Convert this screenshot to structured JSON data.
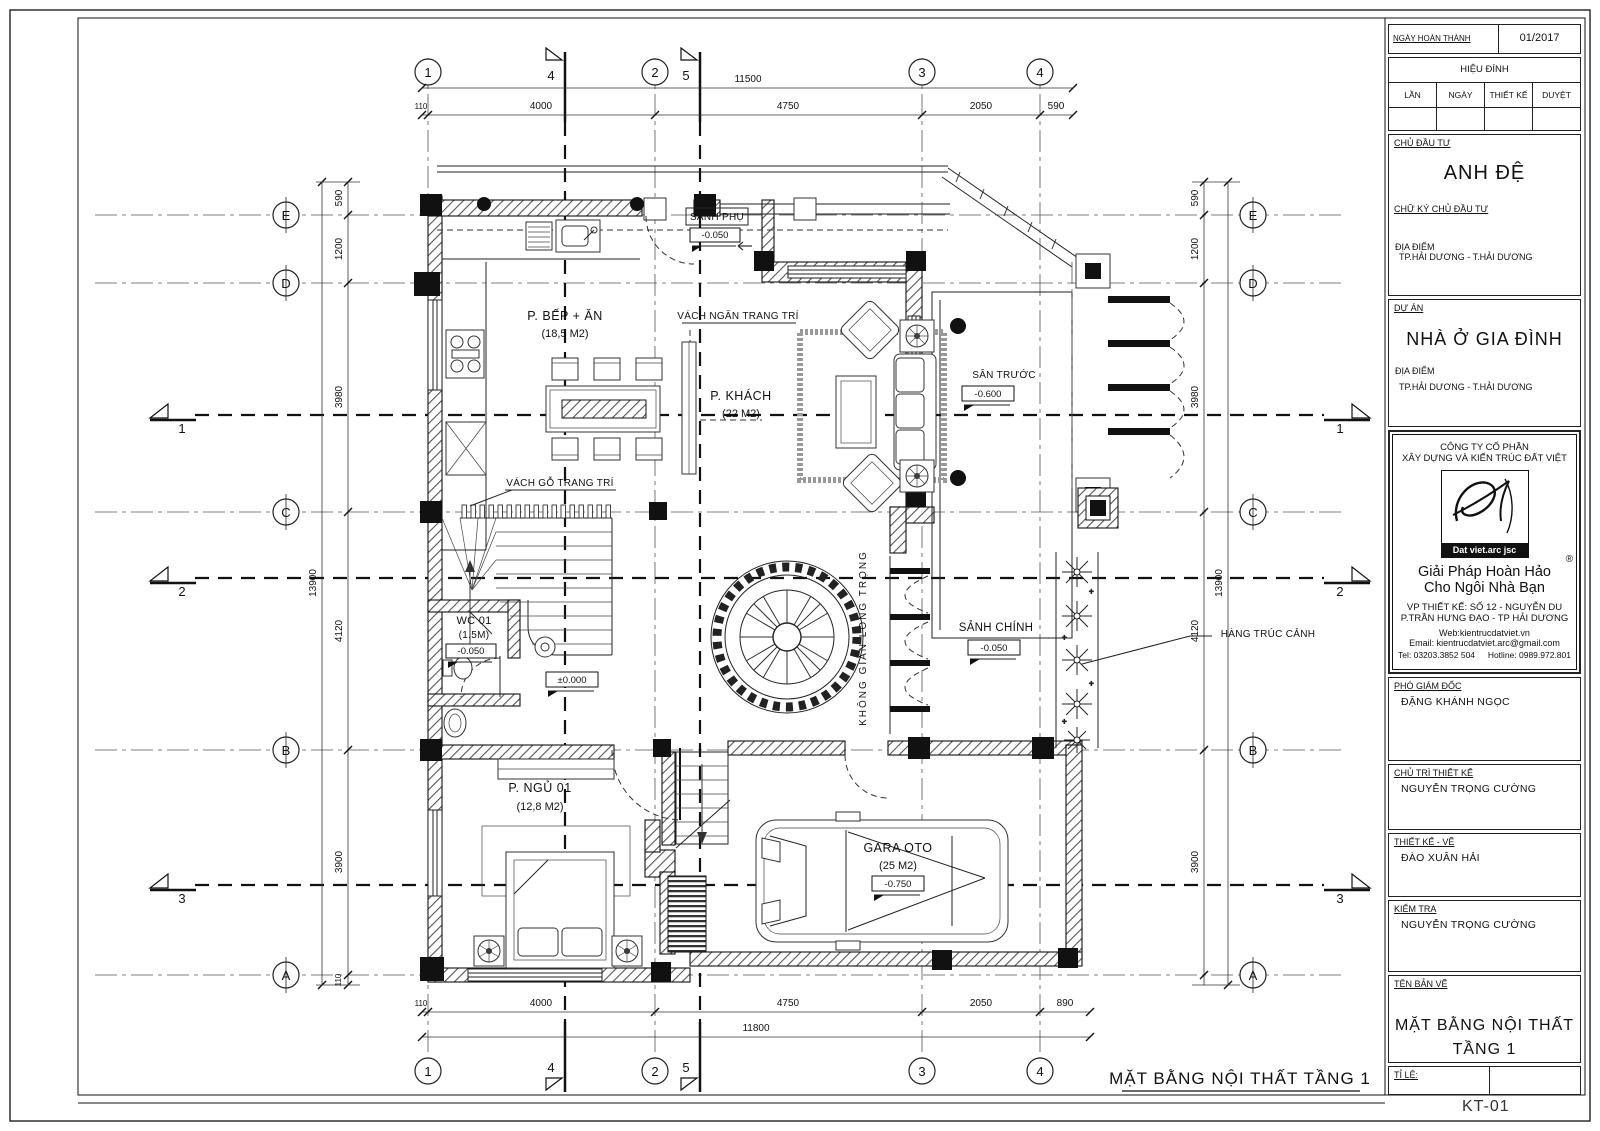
{
  "sheet": {
    "drawing_title": "MẶT BẰNG NỘI THẤT TẦNG 1",
    "sheet_code": "KT-01"
  },
  "title_block": {
    "completion_date_label": "NGÀY HOÀN THÀNH",
    "completion_date": "01/2017",
    "revision_header": "HIỆU ĐÍNH",
    "revision_cols": [
      "LẦN",
      "NGÀY",
      "THIẾT KẾ",
      "DUYỆT"
    ],
    "investor_label": "CHỦ ĐẦU TƯ",
    "investor": "ANH ĐỆ",
    "investor_sign_label": "CHỮ KÝ CHỦ ĐẦU TƯ",
    "location_label": "ĐỊA ĐIỂM",
    "location": "TP.HẢI DƯƠNG - T.HẢI DƯƠNG",
    "project_label": "DỰ ÁN",
    "project": "NHÀ Ở GIA ĐÌNH",
    "company_line1": "CÔNG TY CỔ PHẦN",
    "company_line2": "XÂY DỰNG VÀ KIẾN TRÚC ĐẤT VIỆT",
    "logo_monogram": "D",
    "logo_text": "Dat viet.arc jsc",
    "reg_mark": "®",
    "slogan_line1": "Giải Pháp Hoàn Hảo",
    "slogan_line2": "Cho Ngôi Nhà Bạn",
    "office_line1": "VP THIẾT KẾ: SỐ 12 - NGUYỄN DU",
    "office_line2": "P.TRẦN HƯNG ĐẠO - TP HẢI DƯƠNG",
    "web": "Web:kientrucdatviet.vn",
    "email": "Email: kientrucdatviet.arc@gmail.com",
    "tel": "Tel: 03203.3852 504",
    "hotline": "Hotline: 0989.972.801",
    "deputy_director_label": "PHÓ GIÁM ĐỐC",
    "deputy_director": "ĐẶNG KHÁNH NGỌC",
    "design_lead_label": "CHỦ TRÌ THIẾT KẾ",
    "design_lead": "NGUYỄN TRỌNG CƯỜNG",
    "designer_label": "THIẾT KẾ - VẼ",
    "designer": "ĐÀO XUÂN HẢI",
    "checker_label": "KIỂM TRA",
    "checker": "NGUYỄN TRỌNG CƯỜNG",
    "drawing_name_label": "TÊN BẢN VẼ",
    "drawing_name_line1": "MẶT BẰNG NỘI THẤT",
    "drawing_name_line2": "TẦNG 1",
    "scale_label": "TỈ LỆ:"
  },
  "grid": {
    "cols": [
      "1",
      "2",
      "3",
      "4"
    ],
    "rows": [
      "E",
      "D",
      "C",
      "B",
      "A"
    ],
    "sections": [
      "1",
      "2",
      "3",
      "4",
      "5"
    ]
  },
  "dims": {
    "top": [
      "110",
      "4000",
      "4750",
      "2050",
      "590"
    ],
    "top_total": "11500",
    "bottom": [
      "110",
      "4000",
      "4750",
      "2050",
      "890"
    ],
    "bottom_total": "11800",
    "side": [
      "590",
      "1200",
      "3980",
      "4120",
      "3900"
    ],
    "side_small": "110",
    "side_total": "13900"
  },
  "rooms": {
    "kitchen": {
      "name": "P. BẾP + ĂN",
      "area": "(18,5 M2)"
    },
    "living": {
      "name": "P. KHÁCH",
      "area": "(22 M2)"
    },
    "sub_lobby": {
      "name": "SẢNH PHỤ",
      "level": "-0.050"
    },
    "front_yard": {
      "name": "SÂN TRƯỚC",
      "level": "-0.600"
    },
    "main_lobby": {
      "name": "SẢNH CHÍNH",
      "level": "-0.050"
    },
    "wc": {
      "name": "WC 01",
      "area": "(1.5M)",
      "level": "-0.050"
    },
    "bedroom": {
      "name": "P. NGỦ 01",
      "area": "(12,8 M2)"
    },
    "garage": {
      "name": "GARA OTO",
      "area": "(25 M2)",
      "level": "-0.750"
    },
    "stair": {
      "level": "±0.000"
    }
  },
  "annotations": {
    "partition": "VÁCH NGĂN TRANG TRÍ",
    "wood_wall": "VÁCH GỖ TRANG TRÍ",
    "bamboo": "HÀNG TRÚC CẢNH",
    "void_space": "KHÔNG GIAN LONG TRỌNG"
  }
}
